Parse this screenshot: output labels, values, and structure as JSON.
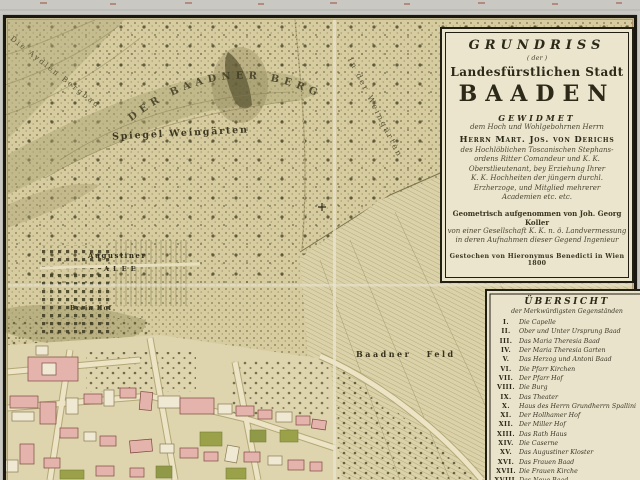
{
  "map": {
    "labels": {
      "berg_arc": "DER  BAADNER  BERG",
      "spiegel": "Spiegel Weingärten",
      "aydlen": "Die Aydlen Bergbad",
      "in_der_weingarten": "In der Weingärten",
      "baadner_feld": "Baadner Feld",
      "augustiner": "Augustiner",
      "alee": "ALEE",
      "brein_hof": "Brein Hof"
    },
    "colors": {
      "paper": "#d6cca0",
      "margin": "#c9c8c2",
      "frame": "#1b180f",
      "cartouche_bg": "#ebe5cd",
      "building_pink": "#e4b3ac",
      "garden_green": "#9aa149",
      "hill_olive": "#8f8658"
    }
  },
  "cartouche": {
    "title": "GRUNDRISS",
    "der": "( der )",
    "stadt": "Landesfürstlichen Stadt",
    "name_big": "BAADEN",
    "gewidmet": "GEWIDMET",
    "dedication_intro": "dem Hoch und Wohlgebohrnen Herrn",
    "dedicatee": "Herrn Mart. Jos. von Derichs",
    "ded_lines": [
      "des Hochlöblichen Toscanischen Stephans-",
      "ordens Ritter Comandeur und K. K.",
      "Oberstlieutenant, bey Erziehung Ihrer",
      "K. K. Hochheiten der jüngern durchl.",
      "Erzherzoge, und Mitglied mehrerer",
      "Academien etc. etc."
    ],
    "survey_line": "Geometrisch aufgenommen von Joh. Georg Koller",
    "survey_lines2": [
      "von einer Gesellschaft K. K. n. ö. Landvermessung",
      "in deren Aufnahmen dieser Gegend Ingenieur"
    ],
    "imprint": "Gestochen von Hieronymus Benedicti in Wien 1800"
  },
  "legend": {
    "title": "ÜBERSICHT",
    "subtitle": "der Merkwürdigsten Gegenständen",
    "items": [
      {
        "numeral": "I.",
        "label": "Die Capelle"
      },
      {
        "numeral": "II.",
        "label": "Ober und Unter Ursprung Baad"
      },
      {
        "numeral": "III.",
        "label": "Das Maria Theresia Baad"
      },
      {
        "numeral": "IV.",
        "label": "Der Maria Theresia Garten"
      },
      {
        "numeral": "V.",
        "label": "Das Herzog und Antoni Baad"
      },
      {
        "numeral": "VI.",
        "label": "Die Pfarr Kirchen"
      },
      {
        "numeral": "VII.",
        "label": "Der Pfarr Hof"
      },
      {
        "numeral": "VIII.",
        "label": "Die Burg"
      },
      {
        "numeral": "IX.",
        "label": "Das Theater"
      },
      {
        "numeral": "X.",
        "label": "Haus des Herrn Grundherrn Spallini"
      },
      {
        "numeral": "XI.",
        "label": "Der Hollhamer Hof"
      },
      {
        "numeral": "XII.",
        "label": "Der Miller Hof"
      },
      {
        "numeral": "XIII.",
        "label": "Das Rath Haus"
      },
      {
        "numeral": "XIV.",
        "label": "Die Caserne"
      },
      {
        "numeral": "XV.",
        "label": "Das Augustiner Kloster"
      },
      {
        "numeral": "XVI.",
        "label": "Das Frauen Baad"
      },
      {
        "numeral": "XVII.",
        "label": "Die Frauen Kirche"
      },
      {
        "numeral": "XVIII.",
        "label": "Das Neue Baad"
      }
    ]
  }
}
